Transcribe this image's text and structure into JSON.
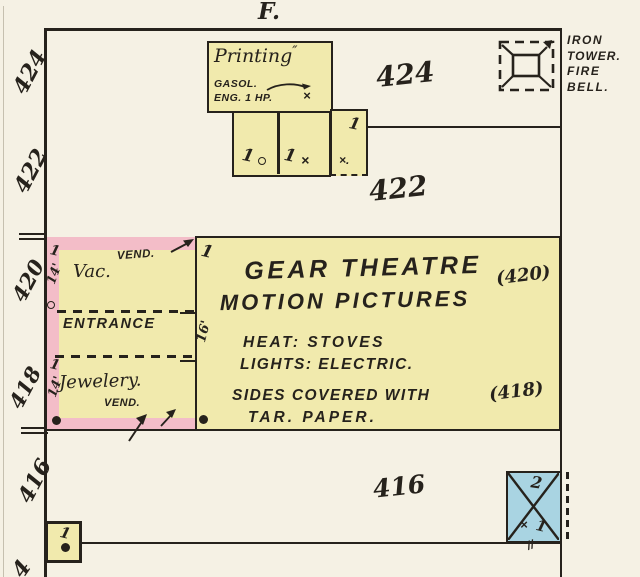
{
  "colors": {
    "paper": "#f5f1e4",
    "building_yellow": "#f1eaad",
    "building_pink": "#f3bdc8",
    "building_blue": "#a9d4e2",
    "ink": "#26221c"
  },
  "street": {
    "label": "F."
  },
  "left_numbers": [
    "424",
    "422",
    "420",
    "418",
    "416",
    "4"
  ],
  "lots": {
    "n424": "424",
    "n422": "422",
    "n416": "416"
  },
  "fire_bell": {
    "lines": [
      "IRON",
      "TOWER.",
      "FIRE",
      "BELL."
    ]
  },
  "printing": {
    "title": "Printing",
    "flourish": "″",
    "gasol": "GASOL.",
    "eng": "ENG. 1 HP."
  },
  "theatre": {
    "title1": "GEAR THEATRE",
    "addr1": "(420)",
    "title2": "MOTION PICTURES",
    "heat": "HEAT: STOVES",
    "lights": "LIGHTS: ELECTRIC.",
    "sides": "SIDES COVERED WITH",
    "addr2": "(418)",
    "tar": "TAR. PAPER.",
    "depth": "16'"
  },
  "shops": {
    "vac": "Vac.",
    "vend": "VEND.",
    "entrance": "ENTRANCE",
    "width_top": "14'",
    "jewelery": "Jewelery.",
    "vend2": "VEND.",
    "width_bottom": "14'"
  },
  "outbuilding": {
    "stories": "2"
  },
  "marks": {
    "one": "1",
    "x": "×",
    "x_dot": "×.",
    "dbl": "//"
  }
}
